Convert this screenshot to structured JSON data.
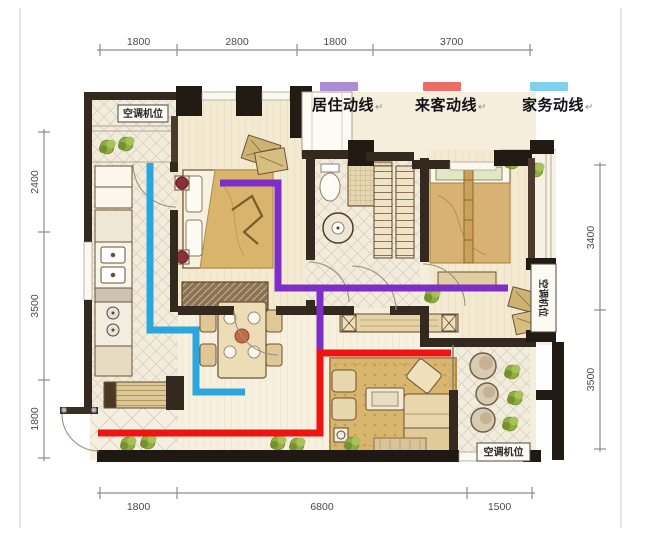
{
  "legend": {
    "items": [
      {
        "label": "居住动线",
        "swatch_color": "#ad8cd6",
        "line_color": "#7d2ec6"
      },
      {
        "label": "来客动线",
        "swatch_color": "#ed6d66",
        "line_color": "#ee1411"
      },
      {
        "label": "家务动线",
        "swatch_color": "#7fd1ef",
        "line_color": "#2ba7de"
      }
    ],
    "return_mark": "↵"
  },
  "room_labels": [
    {
      "text": "空调机位",
      "x": 118,
      "y": 105,
      "w": 50,
      "h": 17,
      "vertical": false
    },
    {
      "text": "空调机位",
      "x": 531,
      "y": 264,
      "w": 25,
      "h": 68,
      "vertical": true
    },
    {
      "text": "空调机位",
      "x": 477,
      "y": 443,
      "w": 53,
      "h": 18,
      "vertical": false
    }
  ],
  "plan": {
    "dimensions": {
      "top": {
        "orientation": "h",
        "axis": 50,
        "text_offset": -5,
        "ticks": [
          100,
          177,
          297,
          373,
          530
        ],
        "labels": [
          "1800",
          "2800",
          "1800",
          "3700"
        ]
      },
      "bottom": {
        "orientation": "h",
        "axis": 493,
        "text_offset": 17,
        "ticks": [
          100,
          177,
          467,
          532
        ],
        "labels": [
          "1800",
          "6800",
          "1500"
        ]
      },
      "left": {
        "orientation": "v",
        "axis": 44,
        "text_offset": -6,
        "ticks": [
          132,
          232,
          380,
          458
        ],
        "labels": [
          "2400",
          "3500",
          "1800"
        ]
      },
      "right": {
        "orientation": "v",
        "axis": 600,
        "text_offset": -6,
        "ticks": [
          165,
          310,
          449
        ],
        "labels": [
          "3400",
          "3500"
        ]
      }
    },
    "circulation": [
      {
        "name": "居住动线",
        "line_color": "#7d2ec6",
        "width": 7,
        "polylines": [
          [
            [
              220,
              183
            ],
            [
              278,
              183
            ],
            [
              278,
              288
            ],
            [
              508,
              288
            ]
          ],
          [
            [
              320,
              288
            ],
            [
              320,
              353
            ]
          ]
        ]
      },
      {
        "name": "来客动线",
        "line_color": "#ee1411",
        "width": 7,
        "polylines": [
          [
            [
              98,
              433
            ],
            [
              320,
              433
            ],
            [
              320,
              353
            ],
            [
              451,
              353
            ]
          ]
        ]
      },
      {
        "name": "家务动线",
        "line_color": "#2ba7de",
        "width": 7,
        "polylines": [
          [
            [
              150,
              163
            ],
            [
              150,
              330
            ],
            [
              196,
              330
            ],
            [
              196,
              392
            ],
            [
              245,
              392
            ]
          ]
        ]
      }
    ]
  }
}
